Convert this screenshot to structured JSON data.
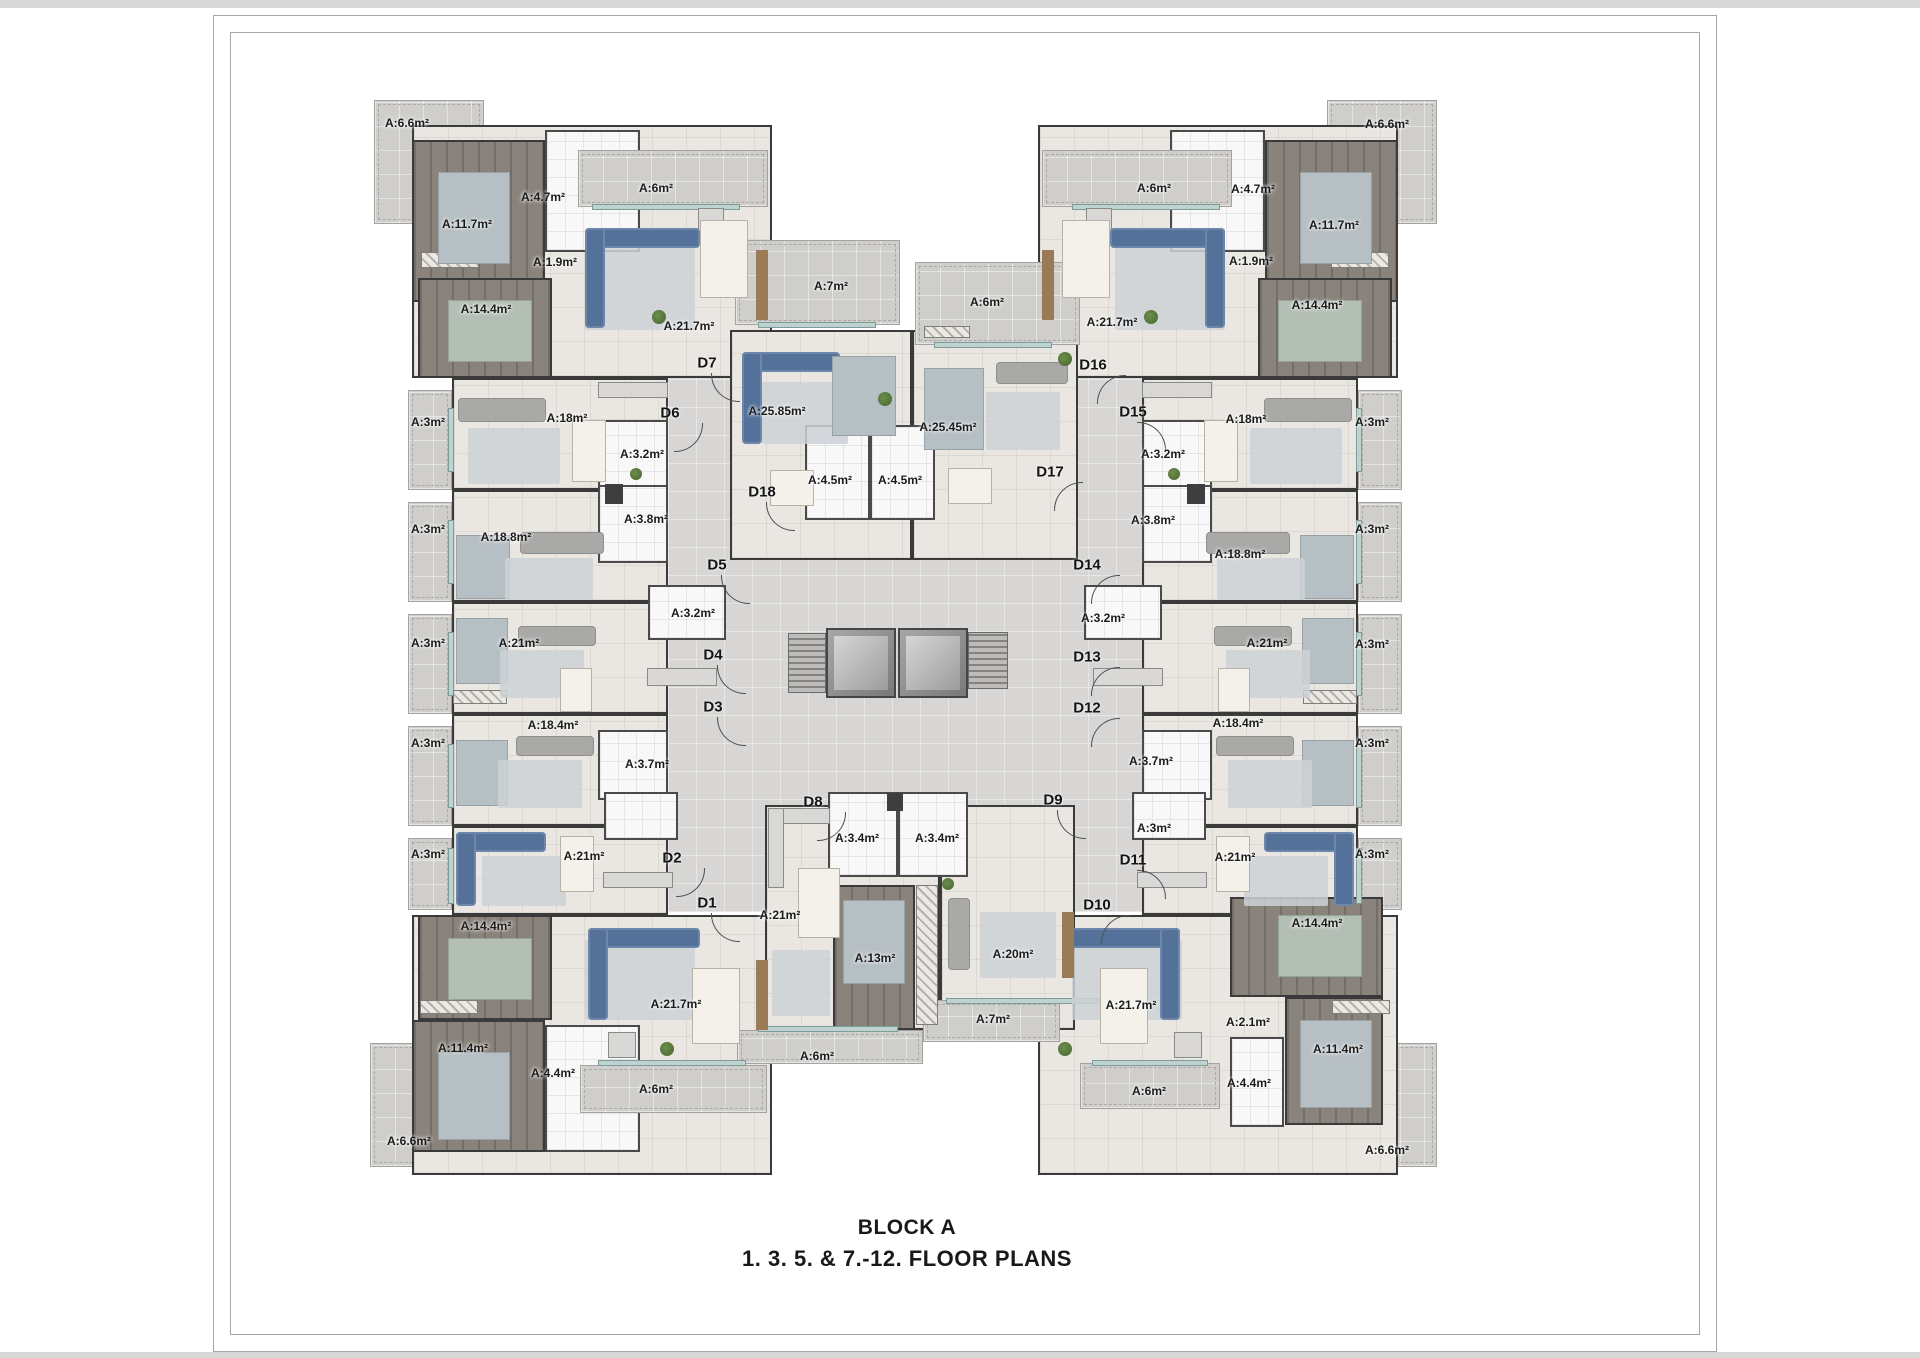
{
  "title": {
    "line1": "BLOCK A",
    "line2": "1. 3. 5. & 7.-12. FLOOR PLANS"
  },
  "colors": {
    "wall": "#3a3a3a",
    "corridor": "#d7d6d4",
    "balcony": "#cfcecb",
    "dark_floor": "#8a837c",
    "sofa_accent": "#54719a",
    "window": "#bed2d0"
  },
  "under_balconies": [
    [
      374,
      100,
      110,
      124
    ],
    [
      1327,
      100,
      110,
      124
    ],
    [
      370,
      1043,
      113,
      124
    ],
    [
      1327,
      1043,
      110,
      124
    ],
    [
      408,
      390,
      44,
      100
    ],
    [
      408,
      502,
      44,
      100
    ],
    [
      408,
      614,
      44,
      100
    ],
    [
      408,
      726,
      44,
      100
    ],
    [
      408,
      838,
      44,
      72
    ],
    [
      1358,
      390,
      44,
      100
    ],
    [
      1358,
      502,
      44,
      100
    ],
    [
      1358,
      614,
      44,
      100
    ],
    [
      1358,
      726,
      44,
      100
    ],
    [
      1358,
      838,
      44,
      72
    ]
  ],
  "corridors": [
    [
      668,
      345,
      479,
      567
    ]
  ],
  "rooms": [
    [
      412,
      125,
      360,
      253,
      "rm"
    ],
    [
      412,
      140,
      133,
      162,
      "dk"
    ],
    [
      545,
      130,
      95,
      122,
      "ba"
    ],
    [
      418,
      278,
      134,
      100,
      "dk"
    ],
    [
      452,
      378,
      216,
      112,
      "rm"
    ],
    [
      452,
      490,
      216,
      112,
      "rm"
    ],
    [
      452,
      602,
      216,
      112,
      "rm"
    ],
    [
      452,
      714,
      216,
      112,
      "rm"
    ],
    [
      452,
      826,
      216,
      89,
      "rm"
    ],
    [
      598,
      420,
      70,
      72,
      "ba"
    ],
    [
      598,
      485,
      70,
      78,
      "ba"
    ],
    [
      648,
      585,
      78,
      55,
      "ba"
    ],
    [
      598,
      730,
      70,
      70,
      "ba"
    ],
    [
      604,
      792,
      74,
      48,
      "ba"
    ],
    [
      412,
      915,
      360,
      260,
      "rm"
    ],
    [
      418,
      915,
      134,
      105,
      "dk"
    ],
    [
      412,
      1020,
      133,
      132,
      "dk"
    ],
    [
      545,
      1025,
      95,
      127,
      "ba"
    ],
    [
      1038,
      125,
      360,
      253,
      "rm"
    ],
    [
      1265,
      140,
      133,
      162,
      "dk"
    ],
    [
      1170,
      130,
      95,
      122,
      "ba"
    ],
    [
      1258,
      278,
      134,
      100,
      "dk"
    ],
    [
      1142,
      378,
      216,
      112,
      "rm"
    ],
    [
      1142,
      490,
      216,
      112,
      "rm"
    ],
    [
      1142,
      602,
      216,
      112,
      "rm"
    ],
    [
      1142,
      714,
      216,
      112,
      "rm"
    ],
    [
      1142,
      826,
      216,
      89,
      "rm"
    ],
    [
      1142,
      420,
      70,
      72,
      "ba"
    ],
    [
      1142,
      485,
      70,
      78,
      "ba"
    ],
    [
      1084,
      585,
      78,
      55,
      "ba"
    ],
    [
      1142,
      730,
      70,
      70,
      "ba"
    ],
    [
      1132,
      792,
      74,
      48,
      "ba"
    ],
    [
      1038,
      915,
      360,
      260,
      "rm"
    ],
    [
      1230,
      897,
      153,
      100,
      "dk"
    ],
    [
      1285,
      997,
      98,
      128,
      "dk"
    ],
    [
      1230,
      1037,
      54,
      90,
      "ba"
    ],
    [
      730,
      330,
      182,
      230,
      "rm"
    ],
    [
      912,
      330,
      166,
      230,
      "rm"
    ],
    [
      805,
      425,
      65,
      95,
      "ba"
    ],
    [
      870,
      425,
      65,
      95,
      "ba"
    ],
    [
      765,
      805,
      175,
      225,
      "rm"
    ],
    [
      833,
      885,
      82,
      145,
      "dk"
    ],
    [
      940,
      805,
      135,
      225,
      "rm"
    ],
    [
      828,
      792,
      70,
      85,
      "ba"
    ],
    [
      898,
      792,
      70,
      85,
      "ba"
    ]
  ],
  "core": [
    [
      788,
      633,
      38,
      60,
      "stair"
    ],
    [
      826,
      628,
      70,
      70,
      "elev"
    ],
    [
      898,
      628,
      70,
      70,
      "elev"
    ],
    [
      968,
      632,
      40,
      57,
      "stair"
    ]
  ],
  "over_balconies": [
    [
      578,
      150,
      190,
      57
    ],
    [
      735,
      240,
      165,
      85
    ],
    [
      915,
      262,
      165,
      83
    ],
    [
      1042,
      150,
      190,
      57
    ],
    [
      580,
      1065,
      187,
      48
    ],
    [
      737,
      1030,
      186,
      34
    ],
    [
      923,
      1000,
      137,
      42
    ],
    [
      1080,
      1063,
      140,
      46
    ]
  ],
  "fixtures": [
    [
      448,
      408,
      6,
      64,
      "win"
    ],
    [
      448,
      520,
      6,
      64,
      "win"
    ],
    [
      448,
      632,
      6,
      64,
      "win"
    ],
    [
      448,
      744,
      6,
      64,
      "win"
    ],
    [
      448,
      848,
      6,
      56,
      "win"
    ],
    [
      1356,
      408,
      6,
      64,
      "win"
    ],
    [
      1356,
      520,
      6,
      64,
      "win"
    ],
    [
      1356,
      632,
      6,
      64,
      "win"
    ],
    [
      1356,
      744,
      6,
      64,
      "win"
    ],
    [
      1356,
      848,
      6,
      56,
      "win"
    ],
    [
      592,
      204,
      148,
      6,
      "win"
    ],
    [
      758,
      322,
      118,
      6,
      "win"
    ],
    [
      934,
      342,
      118,
      6,
      "win"
    ],
    [
      1072,
      204,
      148,
      6,
      "win"
    ],
    [
      598,
      1060,
      148,
      6,
      "win"
    ],
    [
      758,
      1026,
      140,
      6,
      "win"
    ],
    [
      946,
      998,
      160,
      6,
      "win"
    ],
    [
      1092,
      1060,
      116,
      6,
      "win"
    ],
    [
      598,
      382,
      70,
      16,
      "kit"
    ],
    [
      647,
      668,
      70,
      18,
      "kit"
    ],
    [
      603,
      872,
      70,
      16,
      "kit"
    ],
    [
      1142,
      382,
      70,
      16,
      "kit"
    ],
    [
      1093,
      668,
      70,
      18,
      "kit"
    ],
    [
      1137,
      872,
      70,
      16,
      "kit"
    ],
    [
      698,
      208,
      26,
      26,
      "kit"
    ],
    [
      1086,
      208,
      26,
      26,
      "kit"
    ],
    [
      608,
      1032,
      28,
      26,
      "kit"
    ],
    [
      1174,
      1032,
      28,
      26,
      "kit"
    ],
    [
      768,
      808,
      62,
      16,
      "kit"
    ],
    [
      768,
      808,
      16,
      80,
      "kit"
    ],
    [
      421,
      252,
      58,
      16,
      "ward"
    ],
    [
      1331,
      252,
      58,
      16,
      "ward"
    ],
    [
      420,
      1000,
      58,
      14,
      "ward"
    ],
    [
      1332,
      1000,
      58,
      14,
      "ward"
    ],
    [
      453,
      690,
      54,
      14,
      "ward"
    ],
    [
      1303,
      690,
      54,
      14,
      "ward"
    ],
    [
      924,
      326,
      46,
      12,
      "ward"
    ],
    [
      916,
      885,
      22,
      140,
      "ward"
    ],
    [
      605,
      484,
      18,
      20,
      "chip"
    ],
    [
      1187,
      484,
      18,
      20,
      "chip"
    ],
    [
      887,
      793,
      16,
      18,
      "chip"
    ]
  ],
  "furniture": [
    [
      585,
      245,
      110,
      85,
      "rug"
    ],
    [
      585,
      228,
      115,
      20,
      "sofa"
    ],
    [
      585,
      228,
      20,
      100,
      "sofa"
    ],
    [
      700,
      220,
      48,
      78,
      "tbl"
    ],
    [
      652,
      310,
      14,
      14,
      "plant"
    ],
    [
      756,
      250,
      12,
      70,
      "tv"
    ],
    [
      438,
      172,
      72,
      92,
      "bed"
    ],
    [
      448,
      300,
      84,
      62,
      "dbed"
    ],
    [
      1115,
      245,
      110,
      85,
      "rug"
    ],
    [
      1110,
      228,
      115,
      20,
      "sofa"
    ],
    [
      1205,
      228,
      20,
      100,
      "sofa"
    ],
    [
      1062,
      220,
      48,
      78,
      "tbl"
    ],
    [
      1144,
      310,
      14,
      14,
      "plant"
    ],
    [
      1042,
      250,
      12,
      70,
      "tv"
    ],
    [
      1300,
      172,
      72,
      92,
      "bed"
    ],
    [
      1278,
      300,
      84,
      62,
      "dbed"
    ],
    [
      458,
      398,
      88,
      24,
      "gsofa"
    ],
    [
      468,
      428,
      92,
      56,
      "rug"
    ],
    [
      572,
      420,
      34,
      62,
      "tbl"
    ],
    [
      630,
      468,
      12,
      12,
      "plant"
    ],
    [
      456,
      535,
      54,
      64,
      "bed"
    ],
    [
      520,
      532,
      84,
      22,
      "gsofa"
    ],
    [
      505,
      558,
      88,
      42,
      "rug"
    ],
    [
      456,
      618,
      52,
      66,
      "bed"
    ],
    [
      518,
      626,
      78,
      20,
      "gsofa"
    ],
    [
      500,
      650,
      84,
      48,
      "rug"
    ],
    [
      560,
      668,
      32,
      44,
      "tbl"
    ],
    [
      456,
      740,
      52,
      66,
      "bed"
    ],
    [
      516,
      736,
      78,
      20,
      "gsofa"
    ],
    [
      498,
      760,
      84,
      48,
      "rug"
    ],
    [
      456,
      832,
      90,
      20,
      "sofa"
    ],
    [
      456,
      832,
      20,
      74,
      "sofa"
    ],
    [
      482,
      856,
      84,
      50,
      "rug"
    ],
    [
      560,
      836,
      34,
      56,
      "tbl"
    ],
    [
      1264,
      398,
      88,
      24,
      "gsofa"
    ],
    [
      1250,
      428,
      92,
      56,
      "rug"
    ],
    [
      1204,
      420,
      34,
      62,
      "tbl"
    ],
    [
      1168,
      468,
      12,
      12,
      "plant"
    ],
    [
      1300,
      535,
      54,
      64,
      "bed"
    ],
    [
      1206,
      532,
      84,
      22,
      "gsofa"
    ],
    [
      1217,
      558,
      88,
      42,
      "rug"
    ],
    [
      1302,
      618,
      52,
      66,
      "bed"
    ],
    [
      1214,
      626,
      78,
      20,
      "gsofa"
    ],
    [
      1226,
      650,
      84,
      48,
      "rug"
    ],
    [
      1218,
      668,
      32,
      44,
      "tbl"
    ],
    [
      1302,
      740,
      52,
      66,
      "bed"
    ],
    [
      1216,
      736,
      78,
      20,
      "gsofa"
    ],
    [
      1228,
      760,
      84,
      48,
      "rug"
    ],
    [
      1264,
      832,
      90,
      20,
      "sofa"
    ],
    [
      1334,
      832,
      20,
      74,
      "sofa"
    ],
    [
      1244,
      856,
      84,
      50,
      "rug"
    ],
    [
      1216,
      836,
      34,
      56,
      "tbl"
    ],
    [
      448,
      938,
      84,
      62,
      "dbed"
    ],
    [
      438,
      1052,
      72,
      88,
      "bed"
    ],
    [
      585,
      940,
      110,
      80,
      "rug"
    ],
    [
      588,
      928,
      112,
      20,
      "sofa"
    ],
    [
      588,
      928,
      20,
      92,
      "sofa"
    ],
    [
      692,
      968,
      48,
      76,
      "tbl"
    ],
    [
      660,
      1042,
      14,
      14,
      "plant"
    ],
    [
      756,
      960,
      12,
      70,
      "tv"
    ],
    [
      1278,
      915,
      84,
      62,
      "dbed"
    ],
    [
      1300,
      1020,
      72,
      88,
      "bed"
    ],
    [
      1072,
      940,
      110,
      80,
      "rug"
    ],
    [
      1068,
      928,
      112,
      20,
      "sofa"
    ],
    [
      1160,
      928,
      20,
      92,
      "sofa"
    ],
    [
      1100,
      968,
      48,
      76,
      "tbl"
    ],
    [
      1058,
      1042,
      14,
      14,
      "plant"
    ],
    [
      742,
      352,
      98,
      20,
      "sofa"
    ],
    [
      742,
      352,
      20,
      92,
      "sofa"
    ],
    [
      762,
      382,
      86,
      62,
      "rug"
    ],
    [
      832,
      356,
      64,
      80,
      "bed"
    ],
    [
      770,
      470,
      44,
      36,
      "tbl"
    ],
    [
      878,
      392,
      14,
      14,
      "plant"
    ],
    [
      924,
      368,
      60,
      82,
      "bed"
    ],
    [
      996,
      362,
      72,
      22,
      "gsofa"
    ],
    [
      986,
      392,
      74,
      58,
      "rug"
    ],
    [
      948,
      468,
      44,
      36,
      "tbl"
    ],
    [
      1058,
      352,
      14,
      14,
      "plant"
    ],
    [
      798,
      868,
      42,
      70,
      "tbl"
    ],
    [
      772,
      950,
      58,
      66,
      "rug"
    ],
    [
      843,
      900,
      62,
      84,
      "bed"
    ],
    [
      948,
      898,
      22,
      72,
      "gsofa"
    ],
    [
      980,
      912,
      76,
      66,
      "rug"
    ],
    [
      942,
      878,
      12,
      12,
      "plant"
    ],
    [
      1062,
      912,
      12,
      66,
      "tv"
    ]
  ],
  "area_labels": [
    [
      "A:6.6m²",
      407,
      123
    ],
    [
      "A:11.7m²",
      467,
      224
    ],
    [
      "A:4.7m²",
      543,
      197
    ],
    [
      "A:1.9m²",
      555,
      262
    ],
    [
      "A:6m²",
      656,
      188
    ],
    [
      "A:14.4m²",
      486,
      309
    ],
    [
      "A:21.7m²",
      689,
      326
    ],
    [
      "A:3m²",
      428,
      422
    ],
    [
      "A:18m²",
      567,
      418
    ],
    [
      "A:3.2m²",
      642,
      454
    ],
    [
      "A:3m²",
      428,
      529
    ],
    [
      "A:18.8m²",
      506,
      537
    ],
    [
      "A:3.8m²",
      646,
      519
    ],
    [
      "A:3m²",
      428,
      643
    ],
    [
      "A:21m²",
      519,
      643
    ],
    [
      "A:3.2m²",
      693,
      613
    ],
    [
      "A:3m²",
      428,
      743
    ],
    [
      "A:18.4m²",
      553,
      725
    ],
    [
      "A:3.7m²",
      647,
      764
    ],
    [
      "A:3m²",
      428,
      854
    ],
    [
      "A:21m²",
      584,
      856
    ],
    [
      "A:14.4m²",
      486,
      926
    ],
    [
      "A:21.7m²",
      676,
      1004
    ],
    [
      "A:11.4m²",
      463,
      1048
    ],
    [
      "A:4.4m²",
      553,
      1073
    ],
    [
      "A:6m²",
      656,
      1089
    ],
    [
      "A:6.6m²",
      409,
      1141
    ],
    [
      "A:7m²",
      831,
      286
    ],
    [
      "A:6m²",
      987,
      302
    ],
    [
      "A:25.85m²",
      777,
      411
    ],
    [
      "A:25.45m²",
      948,
      427
    ],
    [
      "A:4.5m²",
      830,
      480
    ],
    [
      "A:4.5m²",
      900,
      480
    ],
    [
      "A:3.4m²",
      857,
      838
    ],
    [
      "A:3.4m²",
      937,
      838
    ],
    [
      "A:21m²",
      780,
      915
    ],
    [
      "A:13m²",
      875,
      958
    ],
    [
      "A:20m²",
      1013,
      954
    ],
    [
      "A:6m²",
      817,
      1056
    ],
    [
      "A:7m²",
      993,
      1019
    ],
    [
      "A:6m²",
      1154,
      188
    ],
    [
      "A:4.7m²",
      1253,
      189
    ],
    [
      "A:11.7m²",
      1334,
      225
    ],
    [
      "A:1.9m²",
      1251,
      261
    ],
    [
      "A:14.4m²",
      1317,
      305
    ],
    [
      "A:21.7m²",
      1112,
      322
    ],
    [
      "A:6.6m²",
      1387,
      124
    ],
    [
      "A:3.2m²",
      1163,
      454
    ],
    [
      "A:18m²",
      1246,
      419
    ],
    [
      "A:3m²",
      1372,
      422
    ],
    [
      "A:3.8m²",
      1153,
      520
    ],
    [
      "A:18.8m²",
      1240,
      554
    ],
    [
      "A:3m²",
      1372,
      529
    ],
    [
      "A:3.2m²",
      1103,
      618
    ],
    [
      "A:21m²",
      1267,
      643
    ],
    [
      "A:3m²",
      1372,
      644
    ],
    [
      "A:3.7m²",
      1151,
      761
    ],
    [
      "A:18.4m²",
      1238,
      723
    ],
    [
      "A:3m²",
      1372,
      743
    ],
    [
      "A:3m²",
      1154,
      828
    ],
    [
      "A:21m²",
      1235,
      857
    ],
    [
      "A:3m²",
      1372,
      854
    ],
    [
      "A:21.7m²",
      1131,
      1005
    ],
    [
      "A:14.4m²",
      1317,
      923
    ],
    [
      "A:2.1m²",
      1248,
      1022
    ],
    [
      "A:11.4m²",
      1338,
      1049
    ],
    [
      "A:4.4m²",
      1249,
      1083
    ],
    [
      "A:6m²",
      1149,
      1091
    ],
    [
      "A:6.6m²",
      1387,
      1150
    ]
  ],
  "door_labels": [
    [
      "D1",
      707,
      903,
      0
    ],
    [
      "D2",
      672,
      858,
      270
    ],
    [
      "D3",
      713,
      707,
      0
    ],
    [
      "D4",
      713,
      655,
      0
    ],
    [
      "D5",
      717,
      565,
      0
    ],
    [
      "D6",
      670,
      413,
      270
    ],
    [
      "D7",
      707,
      363,
      0
    ],
    [
      "D8",
      813,
      802,
      270
    ],
    [
      "D9",
      1053,
      800,
      0
    ],
    [
      "D10",
      1097,
      905,
      90
    ],
    [
      "D11",
      1133,
      860,
      180
    ],
    [
      "D12",
      1087,
      708,
      90
    ],
    [
      "D13",
      1087,
      657,
      90
    ],
    [
      "D14",
      1087,
      565,
      90
    ],
    [
      "D15",
      1133,
      412,
      180
    ],
    [
      "D16",
      1093,
      365,
      90
    ],
    [
      "D17",
      1050,
      472,
      90
    ],
    [
      "D18",
      762,
      492,
      0
    ]
  ]
}
